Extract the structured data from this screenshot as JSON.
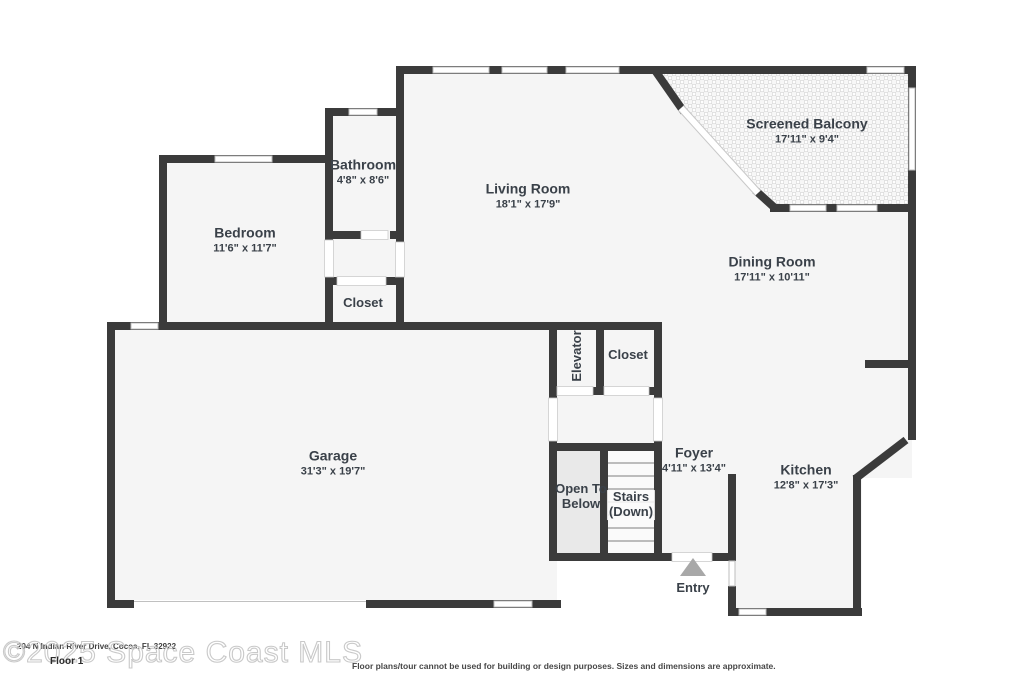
{
  "floor_label": "Floor 1",
  "watermark": "©2025 Space Coast MLS",
  "address_text": "204 N Indian River Drive, Cocoa, FL 32922",
  "disclaimer": "Floor plans/tour cannot be used for building or design purposes. Sizes and dimensions are approximate.",
  "entry_label": "Entry",
  "rooms": {
    "screened_balcony": {
      "name": "Screened Balcony",
      "dims": "17'11\" x 9'4\""
    },
    "living_room": {
      "name": "Living Room",
      "dims": "18'1\" x 17'9\""
    },
    "bathroom": {
      "name": "Bathroom",
      "dims": "4'8\" x 8'6\""
    },
    "bedroom": {
      "name": "Bedroom",
      "dims": "11'6\" x 11'7\""
    },
    "bedroom_closet": {
      "name": "Closet"
    },
    "dining_room": {
      "name": "Dining Room",
      "dims": "17'11\" x 10'11\""
    },
    "elevator": {
      "name": "Elevator"
    },
    "hall_closet": {
      "name": "Closet"
    },
    "garage": {
      "name": "Garage",
      "dims": "31'3\" x 19'7\""
    },
    "open_to_below": {
      "line1": "Open To",
      "line2": "Below"
    },
    "stairs": {
      "line1": "Stairs",
      "line2": "(Down)"
    },
    "foyer": {
      "name": "Foyer",
      "dims": "4'11\" x 13'4\""
    },
    "kitchen": {
      "name": "Kitchen",
      "dims": "12'8\" x 17'3\""
    }
  },
  "colors": {
    "wall": "#3b3b3b",
    "room_fill": "#f5f5f5",
    "open_to_below_fill": "#e9e9e9",
    "label_text": "#3a4149",
    "entry_arrow": "#a8a8a8",
    "balcony_mesh": "#dedede"
  }
}
